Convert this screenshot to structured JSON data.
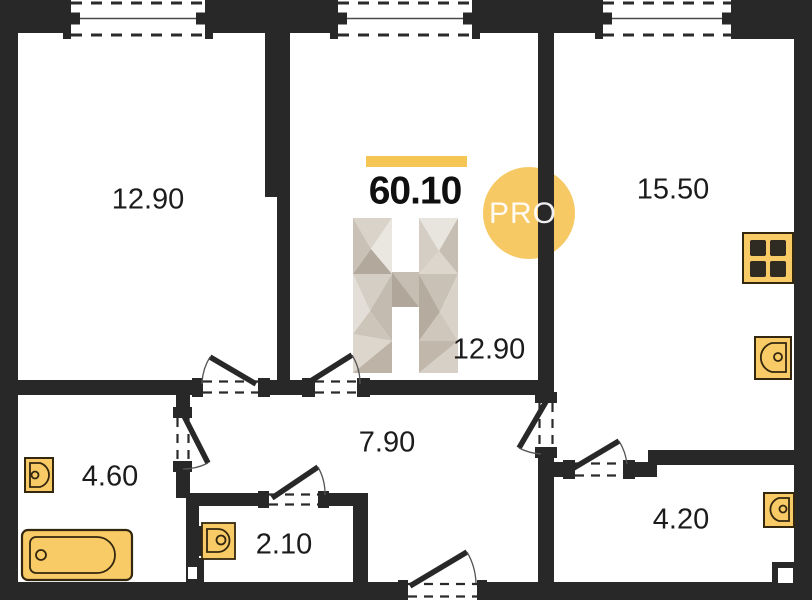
{
  "plan": {
    "title": "Apartment floor plan",
    "header": {
      "total_area": "60.10",
      "badge_label": "PRO"
    },
    "rooms": [
      {
        "name": "room-top-left",
        "area_label": "12.90"
      },
      {
        "name": "room-top-right",
        "area_label": "15.50"
      },
      {
        "name": "room-middle",
        "area_label": "12.90"
      },
      {
        "name": "hallway",
        "area_label": "7.90"
      },
      {
        "name": "bathroom",
        "area_label": "4.60"
      },
      {
        "name": "wc",
        "area_label": "2.10"
      },
      {
        "name": "storage",
        "area_label": "4.20"
      }
    ],
    "icons": [
      "window-icon",
      "door-swing-icon",
      "bathtub-icon",
      "sink-icon",
      "toilet-icon",
      "stove-icon",
      "logo-h-icon",
      "pro-badge"
    ],
    "colors": {
      "wall": "#282828",
      "accent": "#f6c654",
      "fixture_fill": "#f8cb66",
      "fixture_stroke": "#33270f",
      "logo_shades": [
        "#eae6e0",
        "#d5cec4",
        "#c6beb2",
        "#b0a79a"
      ]
    }
  }
}
